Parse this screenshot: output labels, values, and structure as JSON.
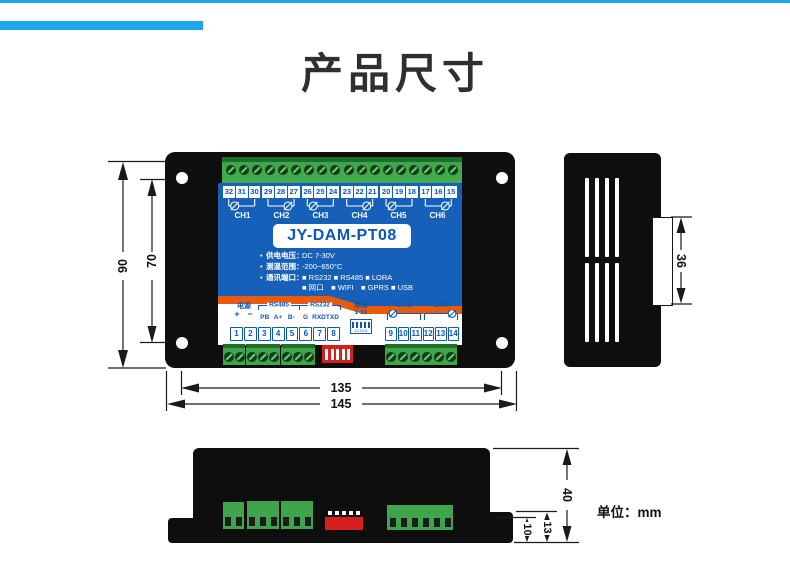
{
  "header": {
    "title": "产品尺寸",
    "accent_color": "#1ba7ea"
  },
  "front_view": {
    "model": "JY-DAM-PT08",
    "top_terminal_groups": [
      {
        "channel": "CH1",
        "terminals": [
          "32",
          "31",
          "30"
        ]
      },
      {
        "channel": "CH2",
        "terminals": [
          "29",
          "28",
          "27"
        ]
      },
      {
        "channel": "CH3",
        "terminals": [
          "26",
          "25",
          "24"
        ]
      },
      {
        "channel": "CH4",
        "terminals": [
          "23",
          "22",
          "21"
        ]
      },
      {
        "channel": "CH5",
        "terminals": [
          "20",
          "19",
          "18"
        ]
      },
      {
        "channel": "CH6",
        "terminals": [
          "17",
          "16",
          "15"
        ]
      }
    ],
    "specs": [
      {
        "bullet": "•",
        "label": "供电电压：",
        "value": "DC 7-30V"
      },
      {
        "bullet": "•",
        "label": "测温范围：",
        "value": "-200~650°C"
      },
      {
        "bullet": "•",
        "label": "通讯端口：",
        "value": "■ RS232 ■ RS485 ■ LORA"
      },
      {
        "bullet": "",
        "label": "",
        "value": "■ 网口　■ WIFI　■ GPRS ■ USB"
      }
    ],
    "bottom_labels": {
      "power": "电源",
      "power_plus": "+",
      "power_minus": "−",
      "rs485": "RS485",
      "rs485_pins": [
        "PB",
        "A+",
        "B-"
      ],
      "rs232": "RS232",
      "rs232_pins": [
        "G",
        "RXD",
        "TXD"
      ],
      "address": "地址",
      "address_range": "1-31",
      "dip_digits": "12345",
      "ch8": "CH8",
      "ch7": "CH7"
    },
    "pin_numbers_left": [
      "1",
      "2",
      "3",
      "4",
      "5",
      "6",
      "7",
      "8"
    ],
    "pin_numbers_right": [
      "9",
      "10",
      "11",
      "12",
      "13",
      "14"
    ]
  },
  "dimensions": {
    "front_height_outer": "90",
    "front_height_inner": "70",
    "front_width_inner": "135",
    "front_width_outer": "145",
    "side_clip_height": "36",
    "bottom_depth": "40",
    "bottom_step": "13",
    "bottom_base": "10",
    "unit": "单位：mm"
  },
  "colors": {
    "panel_blue": "#1760ba",
    "stripe_orange": "#ea5a0c",
    "terminal_green": "#3fa44b",
    "dip_red": "#d5201d",
    "body_black": "#0e0e0e"
  }
}
